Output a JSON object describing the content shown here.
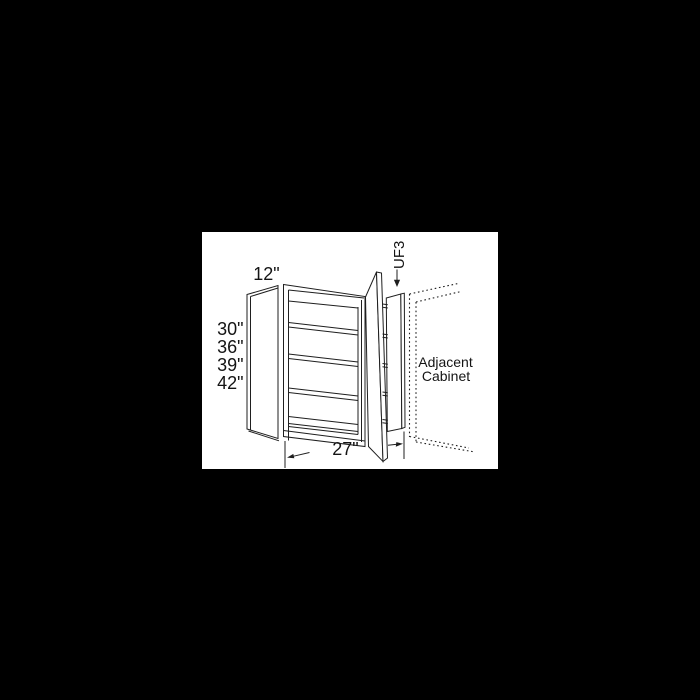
{
  "diagram": {
    "part_code": "UF3",
    "top_depth_label": "12\"",
    "height_options": [
      "30\"",
      "36\"",
      "39\"",
      "42\""
    ],
    "bottom_width_label": "27\"",
    "adjacent_line1": "Adjacent",
    "adjacent_line2": "Cabinet",
    "colors": {
      "background": "#000000",
      "panel": "#ffffff",
      "line": "#1f1f1f",
      "text": "#141414"
    }
  }
}
